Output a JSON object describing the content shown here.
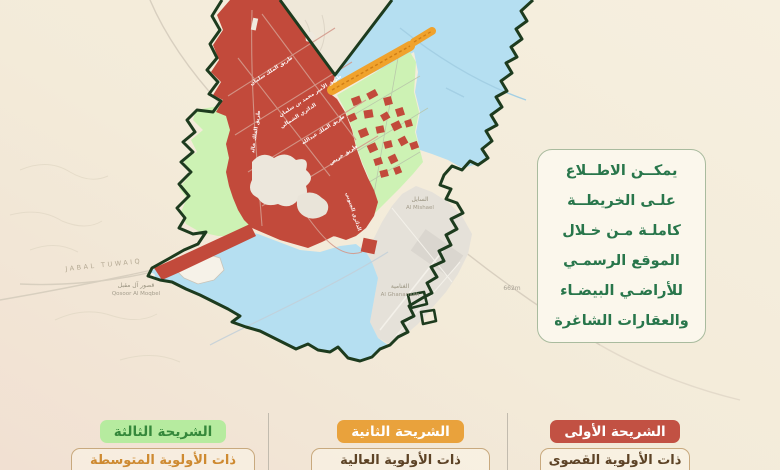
{
  "page": {
    "background": "#f4ecdc"
  },
  "info_panel": {
    "lines": [
      "يمكــن الاطــلاع",
      "علـى الخريطــة",
      "كاملـة مـن خـلال",
      "الموقع الرسمـي",
      "للأراضـي البيضـاء",
      "والعقارات الشاغرة"
    ],
    "text_color": "#28764b"
  },
  "legend": {
    "tranches": [
      {
        "title": "الشريحة الأولى",
        "subtitle": "ذات الأولوية القصوى",
        "chip_bg": "#c25143",
        "chip_text": "#ffffff",
        "subtitle_color": "#5d4326",
        "zone_color": "#c24a3b"
      },
      {
        "title": "الشريحة الثانية",
        "subtitle": "ذات الأولوية العالية",
        "chip_bg": "#e9a23c",
        "chip_text": "#ffffff",
        "subtitle_color": "#5d4326",
        "zone_color": "#f0a22c"
      },
      {
        "title": "الشريحة الثالثة",
        "subtitle": "ذات الأولوية المتوسطة",
        "chip_bg": "#b6eb9f",
        "chip_text": "#35883b",
        "subtitle_color": "#ce8a31",
        "zone_color": "#cdf2b4"
      }
    ]
  },
  "map": {
    "street_labels": [
      "طريق الملك سلمان",
      "طريق الأمير محمد بن سلمان",
      "الدائري الشمالي",
      "طريق الملك عبدالله",
      "طريق خريص",
      "طريق الملك خالد",
      "الدائري الجنوبي"
    ],
    "place_labels": {
      "jabal": "JABAL TUWAIQ",
      "qosoor_ar": "قصور آل مقبل",
      "qosoor_en": "Qosoor Al Moqbel",
      "mishael_ar": "السايل",
      "mishael_en": "Al Mishael",
      "ghanamiah_ar": "الغنامية",
      "ghanamiah_en": "Al Ghanamiah",
      "elevation": "662m"
    },
    "colors": {
      "boundary": "#1d3b1e",
      "tranche_first": "#c24a3b",
      "tranche_second": "#f0a22c",
      "tranche_third": "#cdf2b4",
      "water_zone": "#b5dff1",
      "urban": "#e5e1d9"
    }
  }
}
